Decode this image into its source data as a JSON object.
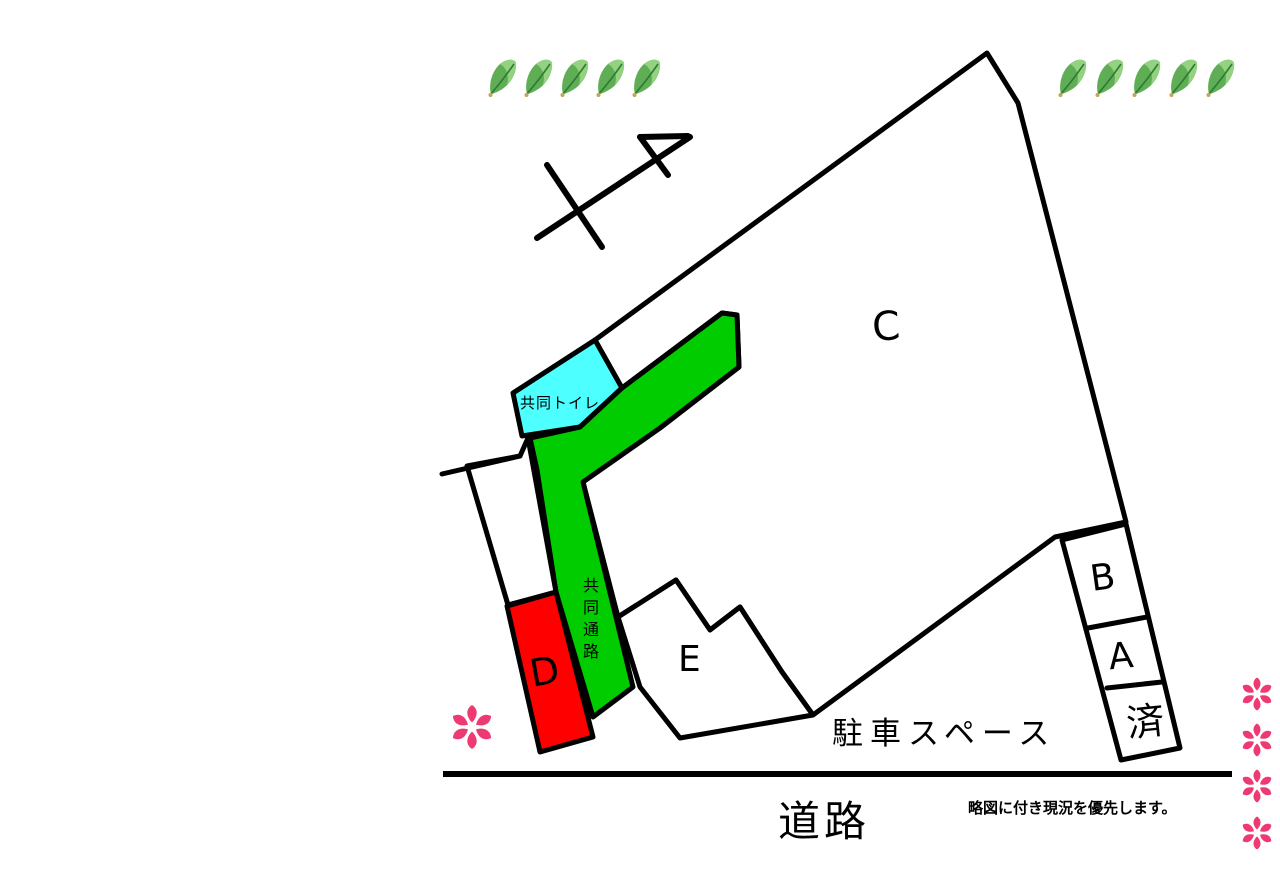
{
  "map": {
    "parcels": {
      "c": "C",
      "b": "B",
      "a": "A",
      "d": "D",
      "e": "E",
      "sold": "済"
    },
    "labels": {
      "shared_toilet": "共同トイレ",
      "shared_passage_chars": [
        "共",
        "同",
        "通",
        "路"
      ],
      "parking_space": "駐車スペース",
      "road": "道路",
      "note": "略図に付き現況を優先します。"
    }
  },
  "colors": {
    "parcel_white": "#ffffff",
    "passage_green": "#00cc00",
    "toilet_cyan": "#4dffff",
    "parcel_d_red": "#ff0000",
    "flower_pink": "#ee3a72",
    "leaf_body": "#5fae55",
    "leaf_light": "#93d27f",
    "leaf_vein": "#2f7a33",
    "leaf_stem": "#c9a44a",
    "line_black": "#000000"
  },
  "icons": {
    "leaf": "leaf-icon",
    "flower": "flower-icon",
    "north_arrow": "north-arrow-icon"
  },
  "decor": {
    "leaf_rows": [
      {
        "x": 487,
        "y": 58,
        "count": 5,
        "spacing": 36,
        "w": 32,
        "h": 40
      },
      {
        "x": 1057,
        "y": 58,
        "count": 5,
        "spacing": 37,
        "w": 32,
        "h": 40
      }
    ],
    "flowers": [
      {
        "x": 472,
        "y": 727,
        "size": 48
      },
      {
        "x": 1257,
        "y": 694,
        "size": 36
      },
      {
        "x": 1257,
        "y": 740,
        "size": 36
      },
      {
        "x": 1257,
        "y": 786,
        "size": 36
      },
      {
        "x": 1257,
        "y": 833,
        "size": 36
      }
    ]
  }
}
